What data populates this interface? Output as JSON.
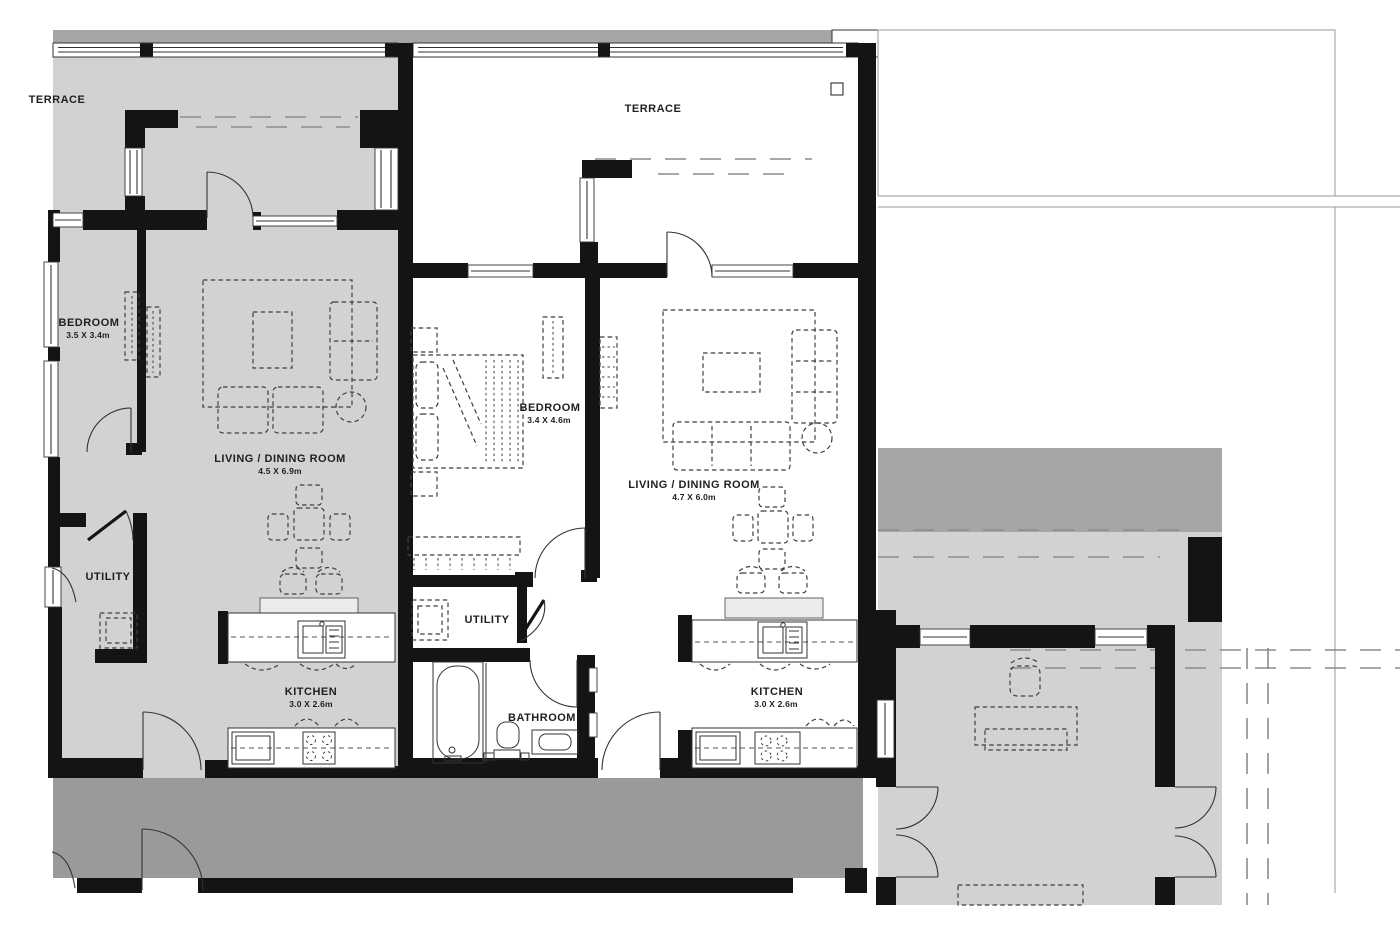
{
  "colors": {
    "background": "#ffffff",
    "wall": "#141414",
    "unit_fill": "#d2d2d2",
    "band_fill": "#a6a6a6",
    "terrace_dark_fill": "#a6a6a6",
    "corridor_fill": "#9a9a9a",
    "line": "#333333",
    "furniture_line": "#3f3f3f",
    "dash_line": "#8c8c8c",
    "text": "#1f1f1f"
  },
  "rooms": {
    "terrace_left": {
      "name": "TERRACE"
    },
    "terrace_center": {
      "name": "TERRACE"
    },
    "bedroom_left": {
      "name": "BEDROOM",
      "dims": "3.5 X 3.4m"
    },
    "living_left": {
      "name": "LIVING / DINING ROOM",
      "dims": "4.5 X 6.9m"
    },
    "utility_left": {
      "name": "UTILITY"
    },
    "kitchen_left": {
      "name": "KITCHEN",
      "dims": "3.0 X 2.6m"
    },
    "bedroom_center": {
      "name": "BEDROOM",
      "dims": "3.4 X 4.6m"
    },
    "living_center": {
      "name": "LIVING / DINING ROOM",
      "dims": "4.7 X 6.0m"
    },
    "utility_center": {
      "name": "UTILITY"
    },
    "bathroom_center": {
      "name": "BATHROOM"
    },
    "kitchen_center": {
      "name": "KITCHEN",
      "dims": "3.0 X 2.6m"
    }
  }
}
